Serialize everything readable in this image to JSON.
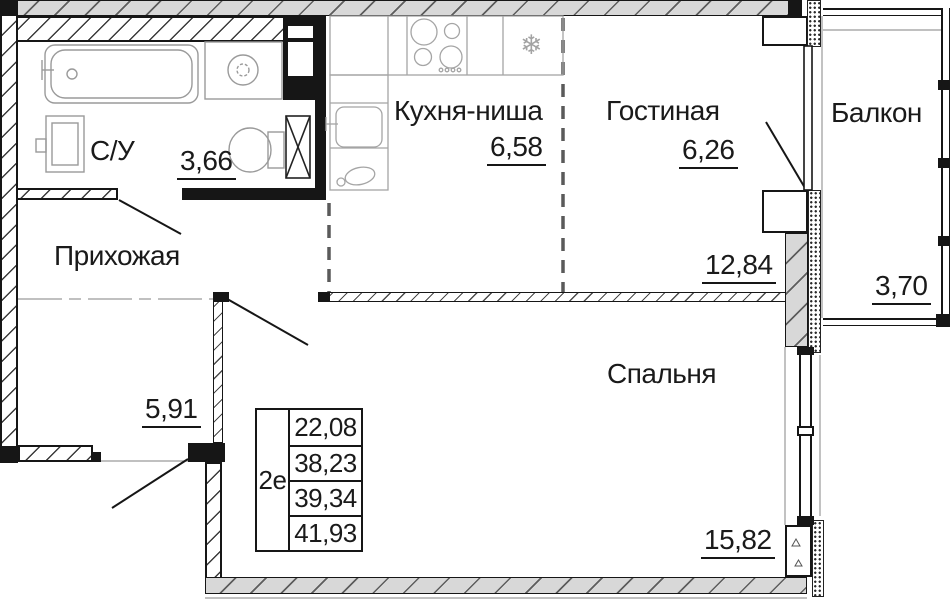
{
  "rooms": {
    "bathroom": {
      "name": "С/У",
      "area": "3,66"
    },
    "hallway": {
      "name": "Прихожая",
      "area": "5,91"
    },
    "kitchen_niche": {
      "name": "Кухня-ниша",
      "area": "6,58"
    },
    "living": {
      "name": "Гостиная",
      "area": "6,26",
      "area_total": "12,84"
    },
    "balcony": {
      "name": "Балкон",
      "area": "3,70"
    },
    "bedroom": {
      "name": "Спальня",
      "area": "15,82"
    }
  },
  "info_table": {
    "apartment_type": "2е",
    "areas": [
      "22,08",
      "38,23",
      "39,34",
      "41,93"
    ]
  },
  "icons": {
    "snowflake": "❄"
  },
  "colors": {
    "line": "#1a1a1a",
    "wall_fill": "#d8d8d8",
    "fixture_line": "#9a9a9a"
  }
}
